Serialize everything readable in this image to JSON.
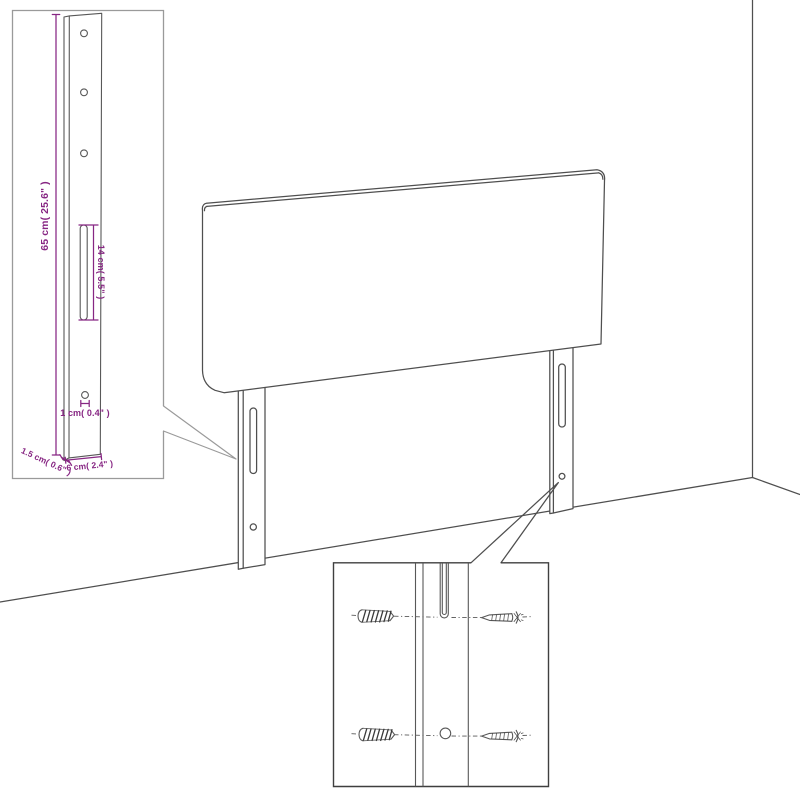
{
  "diagram": {
    "kind": "furniture-assembly-technical-drawing",
    "subject": "upholstered headboard with two mounting legs against a wall corner",
    "colors": {
      "background": "#ffffff",
      "drawing_line": "#4f4f4f",
      "inset_border_light": "#9a9a9a",
      "inset_border_dark": "#3f3f3f",
      "dimension_accent": "#872683"
    },
    "leg_detail_inset": {
      "dimensions": {
        "height": "65 cm( 25.6\" )",
        "slot_length": "14 cm( 5.5\" )",
        "hole_diameter": "1 cm( 0.4\" )",
        "thickness": "1.5 cm( 0.6\" )",
        "width": "6 cm( 2.4\" )"
      }
    },
    "hardware_detail_inset": {
      "icons": {
        "left_column": "threaded-screw-icon",
        "right_column": "pointed-screw-icon"
      },
      "features": [
        "mounting-slot",
        "round-hole"
      ]
    }
  }
}
